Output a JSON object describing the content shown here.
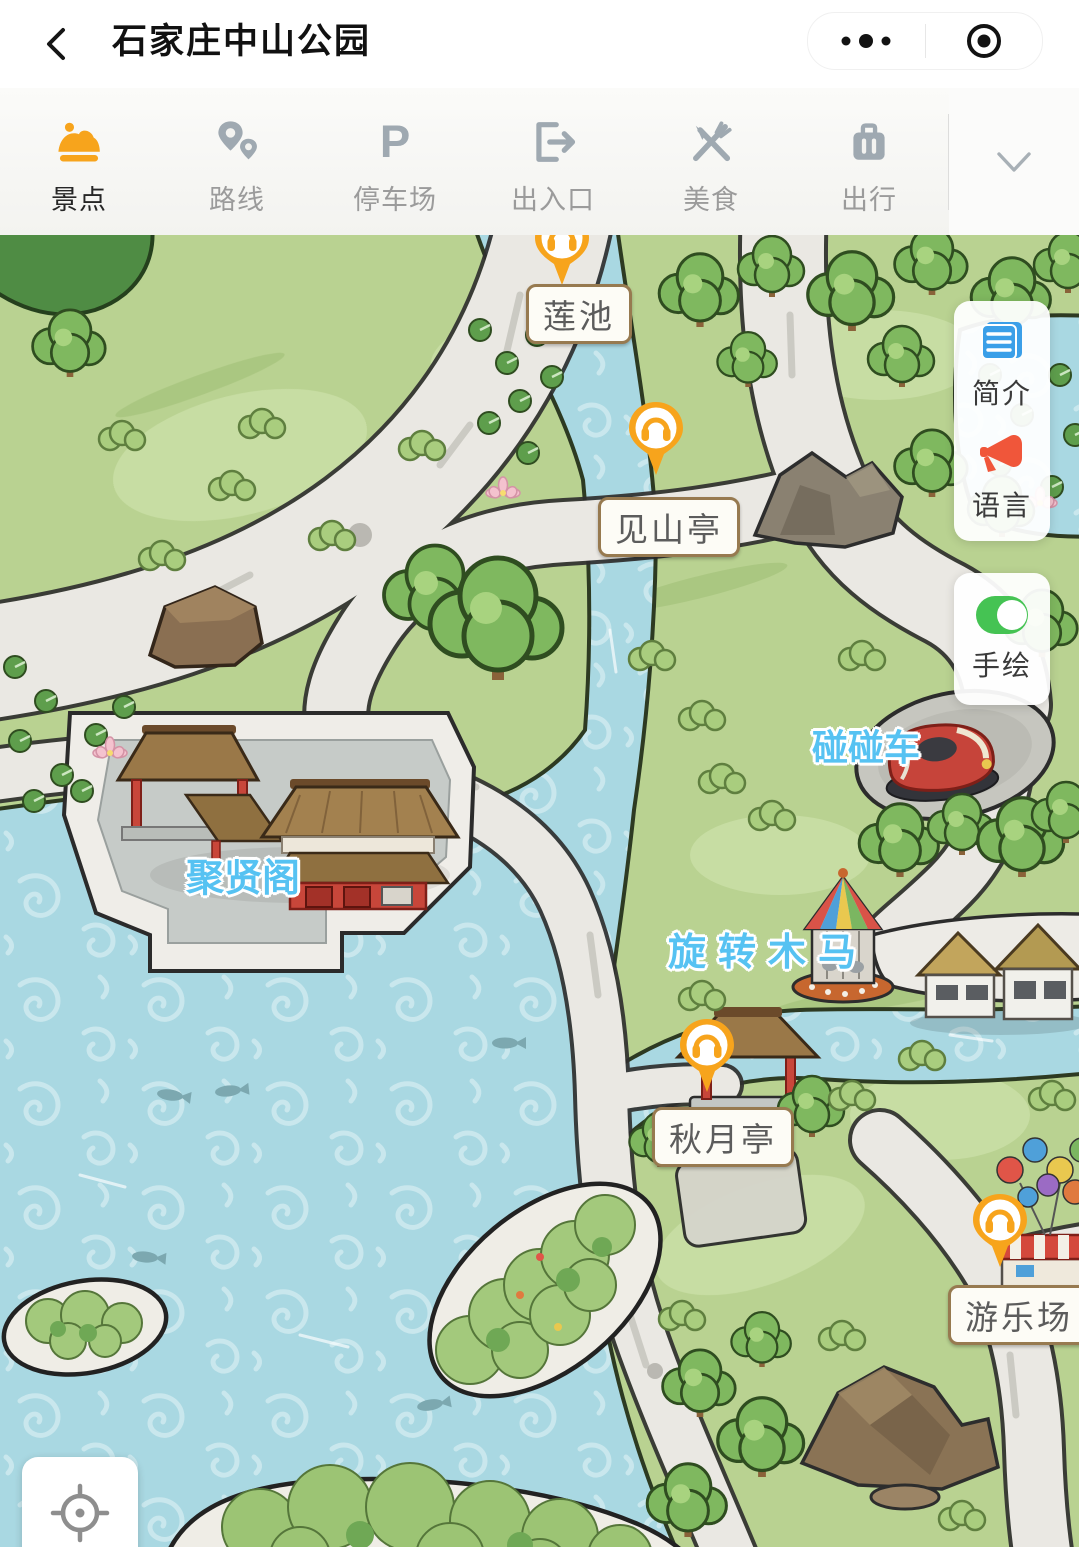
{
  "nav": {
    "title": "石家庄中山公园",
    "back_icon": "chevron-left",
    "menu_icon": "more-dots",
    "target_icon": "circle-target"
  },
  "toolbar": {
    "items": [
      {
        "id": "scenic",
        "label": "景点",
        "icon": "scenic-spot-icon",
        "active": true
      },
      {
        "id": "route",
        "label": "路线",
        "icon": "route-pins-icon",
        "active": false
      },
      {
        "id": "parking",
        "label": "停车场",
        "icon": "parking-icon",
        "active": false
      },
      {
        "id": "gate",
        "label": "出入口",
        "icon": "gate-exit-icon",
        "active": false
      },
      {
        "id": "food",
        "label": "美食",
        "icon": "food-icon",
        "active": false
      },
      {
        "id": "travel",
        "label": "出行",
        "icon": "luggage-icon",
        "active": false
      }
    ],
    "collapse_icon": "chevron-down"
  },
  "map": {
    "audio_markers": [
      {
        "id": "lianchi",
        "label": "莲池",
        "icon": "headphones-pin"
      },
      {
        "id": "jianshanting",
        "label": "见山亭",
        "icon": "headphones-pin"
      },
      {
        "id": "qiuyueting",
        "label": "秋月亭",
        "icon": "headphones-pin"
      },
      {
        "id": "youlechang",
        "label": "游乐场",
        "icon": "headphones-pin"
      }
    ],
    "poi_labels": [
      {
        "id": "juxiange",
        "label": "聚贤阁"
      },
      {
        "id": "pengpengche",
        "label": "碰碰车"
      },
      {
        "id": "xuanzhuanmuma",
        "label": "旋转木马"
      }
    ]
  },
  "floating": {
    "intro_label": "简介",
    "language_label": "语言",
    "hand_drawn_label": "手绘",
    "intro_icon": "document-icon",
    "language_icon": "megaphone-icon",
    "hand_drawn_icon": "toggle-moon-icon",
    "locate_icon": "crosshair-icon"
  },
  "colors": {
    "accent_orange": "#F7A41C",
    "poi_label_blue": "#56C2F2",
    "water": "#A9D8E2",
    "land_green": "#B9D291",
    "walkway": "#EAE8E3"
  }
}
